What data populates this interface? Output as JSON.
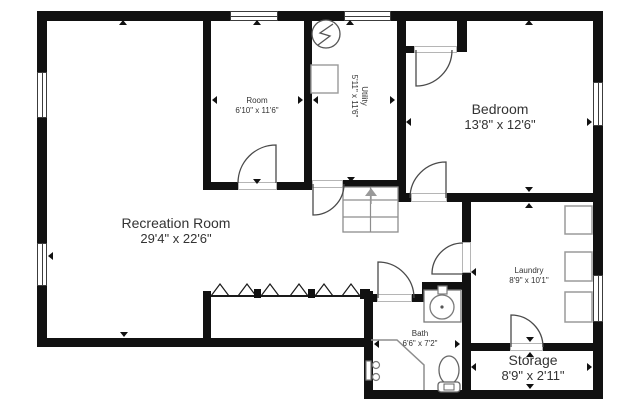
{
  "canvas": {
    "width": 640,
    "height": 412,
    "background": "#ffffff",
    "wall_color": "#111111"
  },
  "rooms": [
    {
      "name": "Room",
      "dims": "6'10\" x 11'6\"",
      "x": 257,
      "y": 106,
      "size": "small"
    },
    {
      "name": "Utility",
      "dims": "5'11\" x 11'6\"",
      "x": 359,
      "y": 96,
      "size": "small",
      "rotate": 90
    },
    {
      "name": "Bedroom",
      "dims": "13'8\" x 12'6\"",
      "x": 500,
      "y": 117,
      "size": "large"
    },
    {
      "name": "Recreation Room",
      "dims": "29'4\" x 22'6\"",
      "x": 176,
      "y": 231,
      "size": "large"
    },
    {
      "name": "Laundry",
      "dims": "8'9\" x 10'1\"",
      "x": 529,
      "y": 276,
      "size": "small"
    },
    {
      "name": "Bath",
      "dims": "6'6\" x 7'2\"",
      "x": 420,
      "y": 339,
      "size": "small"
    },
    {
      "name": "Storage",
      "dims": "8'9\" x 2'11\"",
      "x": 533,
      "y": 368,
      "size": "large"
    }
  ],
  "plan": {
    "walls": [
      [
        37,
        11,
        566,
        10
      ],
      [
        37,
        11,
        10,
        336
      ],
      [
        593,
        11,
        10,
        388
      ],
      [
        37,
        338,
        336,
        9
      ],
      [
        364,
        390,
        239,
        9
      ],
      [
        364,
        291,
        9,
        107
      ],
      [
        203,
        11,
        8,
        179
      ],
      [
        203,
        182,
        35,
        8
      ],
      [
        277,
        182,
        35,
        8
      ],
      [
        304,
        11,
        8,
        177
      ],
      [
        304,
        180,
        8,
        8
      ],
      [
        343,
        180,
        57,
        8
      ],
      [
        397,
        11,
        9,
        191
      ],
      [
        397,
        46,
        17,
        7
      ],
      [
        457,
        19,
        10,
        33
      ],
      [
        397,
        193,
        14,
        9
      ],
      [
        447,
        193,
        146,
        9
      ],
      [
        462,
        202,
        9,
        40
      ],
      [
        462,
        273,
        9,
        117
      ],
      [
        471,
        343,
        39,
        8
      ],
      [
        543,
        343,
        50,
        8
      ],
      [
        364,
        294,
        13,
        8
      ],
      [
        412,
        294,
        12,
        8
      ],
      [
        422,
        282,
        10,
        20
      ],
      [
        422,
        282,
        40,
        8
      ],
      [
        203,
        291,
        8,
        56
      ]
    ],
    "thresholds": [
      [
        238,
        182,
        39,
        8
      ],
      [
        312,
        180,
        31,
        8
      ],
      [
        414,
        46,
        43,
        7
      ],
      [
        411,
        193,
        36,
        9
      ],
      [
        377,
        294,
        35,
        8
      ],
      [
        462,
        242,
        9,
        31
      ],
      [
        510,
        343,
        33,
        8
      ]
    ],
    "windows": [
      [
        37,
        72,
        10,
        46
      ],
      [
        37,
        243,
        10,
        43
      ],
      [
        230,
        11,
        48,
        10
      ],
      [
        344,
        11,
        47,
        10
      ],
      [
        593,
        82,
        10,
        44
      ],
      [
        593,
        275,
        10,
        47
      ]
    ],
    "ticks": [
      [
        123,
        20,
        "up"
      ],
      [
        124,
        337,
        "down"
      ],
      [
        48,
        256,
        "left"
      ],
      [
        257,
        20,
        "up"
      ],
      [
        212,
        100,
        "left"
      ],
      [
        303,
        100,
        "right"
      ],
      [
        257,
        184,
        "down"
      ],
      [
        350,
        20,
        "up"
      ],
      [
        313,
        100,
        "left"
      ],
      [
        395,
        100,
        "right"
      ],
      [
        351,
        182,
        "down"
      ],
      [
        529,
        20,
        "up"
      ],
      [
        529,
        192,
        "down"
      ],
      [
        406,
        122,
        "left"
      ],
      [
        592,
        122,
        "right"
      ],
      [
        529,
        203,
        "up"
      ],
      [
        530,
        342,
        "down"
      ],
      [
        471,
        272,
        "left"
      ],
      [
        471,
        367,
        "left"
      ],
      [
        592,
        367,
        "right"
      ],
      [
        530,
        352,
        "up"
      ],
      [
        530,
        389,
        "down"
      ],
      [
        374,
        344,
        "left"
      ],
      [
        460,
        344,
        "right"
      ]
    ],
    "vector": [
      {
        "n": "stairs-outline",
        "t": "rect",
        "a": {
          "x": 343,
          "y": 187,
          "width": 55,
          "height": 45,
          "fill": "#ffffff",
          "stroke": "#8d8d8d",
          "stroke-width": 1.3
        }
      },
      {
        "n": "stairs-center-rail",
        "t": "line",
        "a": {
          "x1": 370.5,
          "y1": 187,
          "x2": 370.5,
          "y2": 232,
          "stroke": "#8d8d8d",
          "stroke-width": 1.2
        }
      },
      {
        "n": "stairs-tread",
        "t": "line",
        "a": {
          "x1": 343,
          "y1": 200,
          "x2": 398,
          "y2": 200,
          "stroke": "#8d8d8d",
          "stroke-width": 1.2
        }
      },
      {
        "n": "stairs-tread",
        "t": "line",
        "a": {
          "x1": 343,
          "y1": 217,
          "x2": 398,
          "y2": 217,
          "stroke": "#8d8d8d",
          "stroke-width": 1.2
        }
      },
      {
        "n": "stairs-up-arrow",
        "t": "line",
        "a": {
          "x1": 371,
          "y1": 204,
          "x2": 371,
          "y2": 196,
          "stroke": "#999999",
          "stroke-width": 1.4
        }
      },
      {
        "n": "stairs-up-arrow-head",
        "t": "polygon",
        "a": {
          "points": "365,196 377,196 371,188",
          "fill": "#999999"
        }
      },
      {
        "n": "water-heater-icon",
        "t": "circle",
        "a": {
          "cx": 326,
          "cy": 34,
          "r": 14,
          "fill": "#ffffff",
          "stroke": "#555555",
          "stroke-width": 1.3
        }
      },
      {
        "n": "lightning-bolt-icon",
        "t": "path",
        "a": {
          "d": "M333,24 L320,33 L330,36 L318,45",
          "fill": "none",
          "stroke": "#555555",
          "stroke-width": 1.3
        }
      },
      {
        "n": "utility-unit",
        "t": "rect",
        "a": {
          "x": 311,
          "y": 65,
          "width": 27,
          "height": 28,
          "fill": "#ffffff",
          "stroke": "#9a9a9a",
          "stroke-width": 1.4
        }
      },
      {
        "n": "door-swing-room",
        "t": "path",
        "a": {
          "d": "M276,183 L276,145 A38,38 0 0 0 238,183",
          "fill": "none",
          "stroke": "#4a4a4a",
          "stroke-width": 1.3
        }
      },
      {
        "n": "door-swing-utility",
        "t": "path",
        "a": {
          "d": "M313,184 L313,215 A31,31 0 0 0 344,184",
          "fill": "none",
          "stroke": "#4a4a4a",
          "stroke-width": 1.3
        }
      },
      {
        "n": "door-swing-closet",
        "t": "path",
        "a": {
          "d": "M416,50 L416,86 A36,36 0 0 0 452,50",
          "fill": "none",
          "stroke": "#4a4a4a",
          "stroke-width": 1.3
        }
      },
      {
        "n": "door-swing-bedroom",
        "t": "path",
        "a": {
          "d": "M446,198 L446,162 A36,36 0 0 0 410,198",
          "fill": "none",
          "stroke": "#4a4a4a",
          "stroke-width": 1.3
        }
      },
      {
        "n": "door-swing-bath",
        "t": "path",
        "a": {
          "d": "M378,298 L378,262 A36,36 0 0 1 414,298",
          "fill": "none",
          "stroke": "#4a4a4a",
          "stroke-width": 1.3
        }
      },
      {
        "n": "door-swing-laundry",
        "t": "path",
        "a": {
          "d": "M463,274 L432,274 A31,31 0 0 1 463,243",
          "fill": "none",
          "stroke": "#4a4a4a",
          "stroke-width": 1.3
        }
      },
      {
        "n": "door-swing-storage",
        "t": "path",
        "a": {
          "d": "M511,347 L511,315 A32,32 0 0 1 543,347",
          "fill": "none",
          "stroke": "#4a4a4a",
          "stroke-width": 1.3
        }
      },
      {
        "n": "divider-line",
        "t": "line",
        "a": {
          "x1": 211,
          "y1": 296,
          "x2": 364,
          "y2": 296,
          "stroke": "#1a1a1a",
          "stroke-width": 2
        }
      },
      {
        "n": "divider-zigzag",
        "t": "path",
        "a": {
          "d": "M211,296 L220,284 L229,296 M238,296 L247,284 L256,296 M261,296 L270,284 L279,296 M290,296 L299,284 L308,296 M315,296 L324,284 L333,296 M342,296 L351,284 L360,296",
          "fill": "none",
          "stroke": "#1a1a1a",
          "stroke-width": 1.2
        }
      },
      {
        "n": "divider-post",
        "t": "rect",
        "a": {
          "x": 254,
          "y": 289,
          "width": 7,
          "height": 9,
          "fill": "#111111"
        }
      },
      {
        "n": "divider-post",
        "t": "rect",
        "a": {
          "x": 308,
          "y": 289,
          "width": 7,
          "height": 9,
          "fill": "#111111"
        }
      },
      {
        "n": "divider-post",
        "t": "rect",
        "a": {
          "x": 360,
          "y": 289,
          "width": 10,
          "height": 10,
          "fill": "#111111"
        }
      },
      {
        "n": "vanity-counter",
        "t": "rect",
        "a": {
          "x": 424,
          "y": 290,
          "width": 37,
          "height": 32,
          "fill": "#ffffff",
          "stroke": "#7a7a7a",
          "stroke-width": 1.3
        }
      },
      {
        "n": "sink-faucet",
        "t": "rect",
        "a": {
          "x": 438,
          "y": 286,
          "width": 9,
          "height": 8,
          "fill": "#ffffff",
          "stroke": "#7a7a7a",
          "stroke-width": 1.2
        }
      },
      {
        "n": "sink-basin",
        "t": "circle",
        "a": {
          "cx": 442,
          "cy": 307,
          "r": 12,
          "fill": "#ffffff",
          "stroke": "#7a7a7a",
          "stroke-width": 1.3
        }
      },
      {
        "n": "sink-drain",
        "t": "circle",
        "a": {
          "cx": 442,
          "cy": 307,
          "r": 1.6,
          "fill": "#555555"
        }
      },
      {
        "n": "toilet-bowl",
        "t": "ellipse",
        "a": {
          "cx": 449,
          "cy": 370,
          "rx": 10,
          "ry": 14,
          "fill": "#ffffff",
          "stroke": "#666666",
          "stroke-width": 1.3
        }
      },
      {
        "n": "toilet-tank",
        "t": "rect",
        "a": {
          "x": 438,
          "y": 382,
          "width": 22,
          "height": 10,
          "rx": 3,
          "fill": "#ffffff",
          "stroke": "#666666",
          "stroke-width": 1.3
        }
      },
      {
        "n": "toilet-flush",
        "t": "rect",
        "a": {
          "x": 444,
          "y": 384,
          "width": 10,
          "height": 6,
          "fill": "#ffffff",
          "stroke": "#666666",
          "stroke-width": 1
        }
      },
      {
        "n": "shower-enclosure",
        "t": "polyline",
        "a": {
          "points": "371,340 397,340 424,365 424,390",
          "fill": "none",
          "stroke": "#8d8d8d",
          "stroke-width": 1.5
        }
      },
      {
        "n": "shower-valve",
        "t": "rect",
        "a": {
          "x": 366,
          "y": 361,
          "width": 5,
          "height": 19,
          "fill": "#ffffff",
          "stroke": "#7a7a7a",
          "stroke-width": 1.2
        }
      },
      {
        "n": "shower-knob",
        "t": "circle",
        "a": {
          "cx": 376,
          "cy": 365,
          "r": 3.5,
          "fill": "#ffffff",
          "stroke": "#7a7a7a",
          "stroke-width": 1.2
        }
      },
      {
        "n": "shower-knob",
        "t": "circle",
        "a": {
          "cx": 376,
          "cy": 377,
          "r": 3.5,
          "fill": "#ffffff",
          "stroke": "#7a7a7a",
          "stroke-width": 1.2
        }
      },
      {
        "n": "washer",
        "t": "rect",
        "a": {
          "x": 565,
          "y": 206,
          "width": 27,
          "height": 28,
          "fill": "#ffffff",
          "stroke": "#9a9a9a",
          "stroke-width": 1.5
        }
      },
      {
        "n": "dryer",
        "t": "rect",
        "a": {
          "x": 565,
          "y": 252,
          "width": 27,
          "height": 29,
          "fill": "#ffffff",
          "stroke": "#9a9a9a",
          "stroke-width": 1.5
        }
      },
      {
        "n": "laundry-tub",
        "t": "rect",
        "a": {
          "x": 565,
          "y": 292,
          "width": 27,
          "height": 30,
          "fill": "#ffffff",
          "stroke": "#9a9a9a",
          "stroke-width": 1.5
        }
      }
    ]
  }
}
